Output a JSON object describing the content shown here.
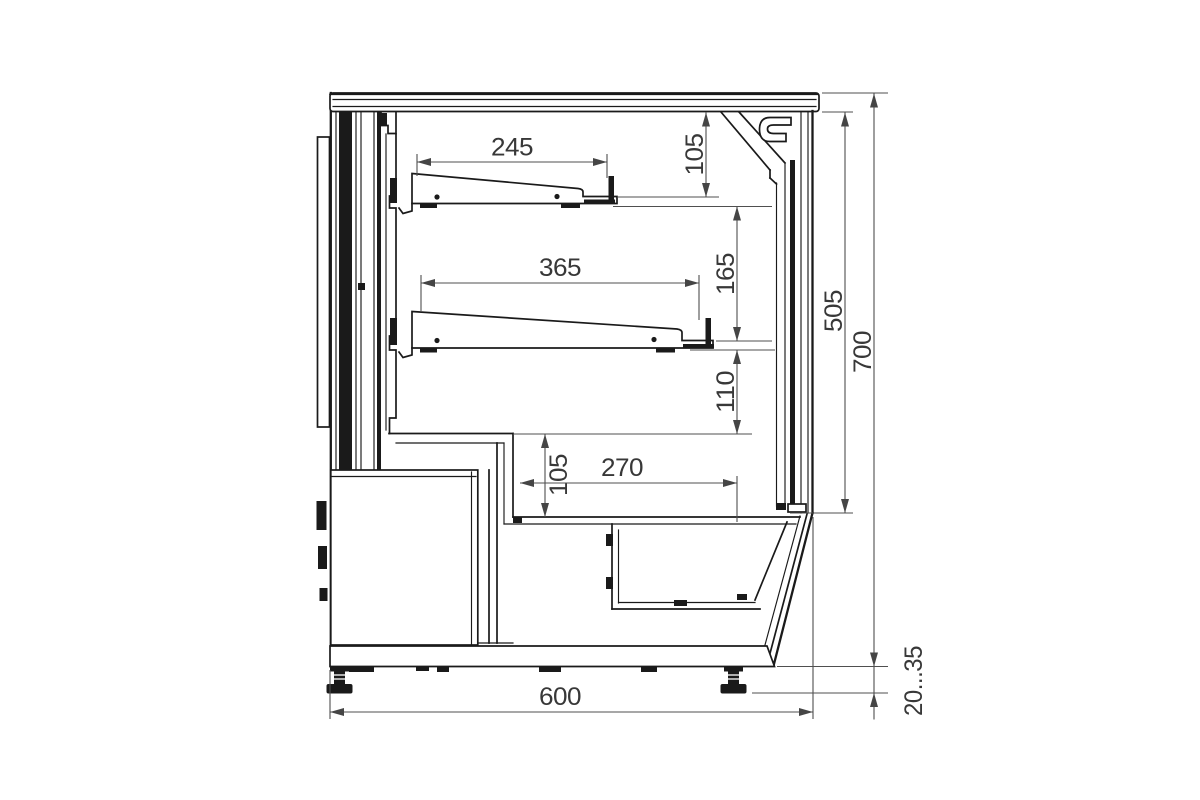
{
  "page": {
    "background": "#ffffff",
    "width": 1200,
    "height": 800
  },
  "drawing": {
    "kind": "technical-section-drawing",
    "line_color": "#1a1a1a",
    "dim_color": "#4f4f4f",
    "text_color": "#383838",
    "dimensions": {
      "d245": {
        "label": "245"
      },
      "d105_top": {
        "label": "105"
      },
      "d365": {
        "label": "365"
      },
      "d165": {
        "label": "165"
      },
      "d110": {
        "label": "110"
      },
      "d105_step": {
        "label": "105"
      },
      "d270": {
        "label": "270"
      },
      "d505": {
        "label": "505"
      },
      "d700": {
        "label": "700"
      },
      "d600": {
        "label": "600"
      },
      "d20_35": {
        "label": "20...35"
      }
    }
  }
}
